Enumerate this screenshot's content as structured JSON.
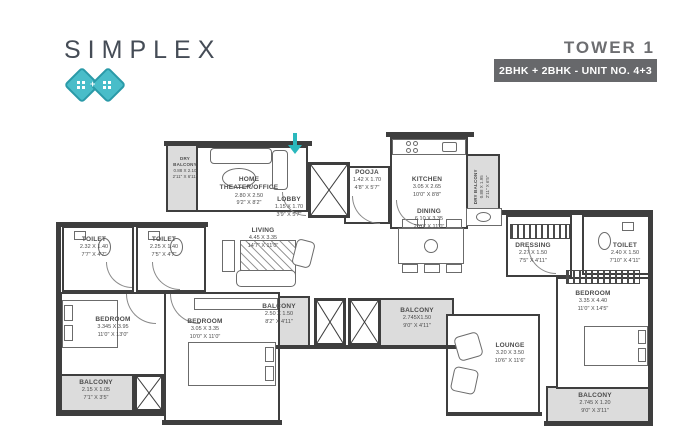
{
  "header": {
    "brand": "SIMPLEX",
    "tower": "TOWER 1",
    "unit_info": "2BHK + 2BHK - UNIT NO. 4+3",
    "logo_plus": "+",
    "accent_color": "#49bdc9",
    "badge_bg": "#67686b"
  },
  "rooms": [
    {
      "name": "DRY BALCONY",
      "dim_m": "0.88 X 2.10",
      "dim_ft": "2'11\" X 6'11\""
    },
    {
      "name": "HOME THEATER/OFFICE",
      "dim_m": "2.80 X 2.50",
      "dim_ft": "9'2\" X 8'2\""
    },
    {
      "name": "LOBBY",
      "dim_m": "1.15 X 1.70",
      "dim_ft": "3'9\" X 5'7\""
    },
    {
      "name": "POOJA",
      "dim_m": "1.42 X 1.70",
      "dim_ft": "4'8\" X 5'7\""
    },
    {
      "name": "KITCHEN",
      "dim_m": "3.05 X 2.65",
      "dim_ft": "10'0\" X 8'8\""
    },
    {
      "name": "DRY BALCONY",
      "dim_m": "0.88 X 1.95",
      "dim_ft": "2'11\" X 6'5\""
    },
    {
      "name": "LIVING",
      "dim_m": "4.45 X 3.35",
      "dim_ft": "14'7\" X 11'0\""
    },
    {
      "name": "DINING",
      "dim_m": "6.10 X 3.35",
      "dim_ft": "20'0\" X 11'0\""
    },
    {
      "name": "TOILET",
      "dim_m": "2.32 X 1.40",
      "dim_ft": "7'7\" X 4'7\""
    },
    {
      "name": "TOILET",
      "dim_m": "2.25 X 1.40",
      "dim_ft": "7'5\" X 4'7\""
    },
    {
      "name": "BEDROOM",
      "dim_m": "3.345 X 3.95",
      "dim_ft": "11'0\" X 13'0\""
    },
    {
      "name": "BALCONY",
      "dim_m": "2.15 X 1.05",
      "dim_ft": "7'1\" X 3'5\""
    },
    {
      "name": "BEDROOM",
      "dim_m": "3.05 X 3.35",
      "dim_ft": "10'0\" X 11'0\""
    },
    {
      "name": "BALCONY",
      "dim_m": "2.50 X 1.50",
      "dim_ft": "8'2\" X 4'11\""
    },
    {
      "name": "BALCONY",
      "dim_m": "2.745X1.50",
      "dim_ft": "9'0\" X 4'11\""
    },
    {
      "name": "DRESSING",
      "dim_m": "2.27 X 1.50",
      "dim_ft": "7'5\" X 4'11\""
    },
    {
      "name": "TOILET",
      "dim_m": "2.40 X 1.50",
      "dim_ft": "7'10\" X 4'11\""
    },
    {
      "name": "BEDROOM",
      "dim_m": "3.35 X 4.40",
      "dim_ft": "11'0\" X 14'5\""
    },
    {
      "name": "LOUNGE",
      "dim_m": "3.20 X 3.50",
      "dim_ft": "10'6\" X 11'6\""
    },
    {
      "name": "BALCONY",
      "dim_m": "2.745 X 1.20",
      "dim_ft": "9'0\" X 3'11\""
    }
  ]
}
